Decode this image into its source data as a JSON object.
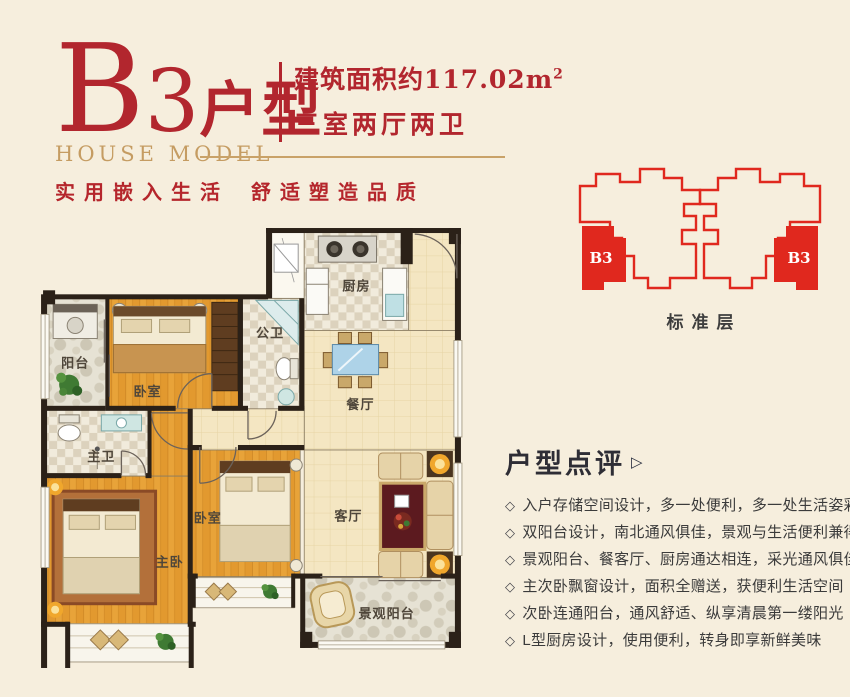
{
  "colors": {
    "background": "#f6eedd",
    "accent_red": "#b2262e",
    "keyplan_red": "#e0281e",
    "gold": "#c59c62",
    "text_dark": "#3b3b3b",
    "wall": "#2b2118",
    "wood_floor": "#e2992f",
    "tile_floor": "#f4e6c2"
  },
  "header": {
    "title_b": "B",
    "title_3": "3",
    "title_suffix": "户型",
    "subtitle_en": "HOUSE MODEL",
    "area_prefix": "建筑面积约",
    "area_value": "117.02",
    "area_unit": "m",
    "area_sup": "2",
    "layout_text": "三室两厅两卫",
    "tagline_left": "实用嵌入生活",
    "tagline_right": "舒适塑造品质"
  },
  "keyplan": {
    "unit_left": "B3",
    "unit_right": "B3",
    "caption": "标准层"
  },
  "floorplan": {
    "rooms": [
      {
        "label": "阳台"
      },
      {
        "label": "卧室"
      },
      {
        "label": "公卫"
      },
      {
        "label": "厨房"
      },
      {
        "label": "餐厅"
      },
      {
        "label": "主卫"
      },
      {
        "label": "主卧"
      },
      {
        "label": "卧室"
      },
      {
        "label": "客厅"
      },
      {
        "label": "景观阳台"
      }
    ]
  },
  "review": {
    "title": "户型点评",
    "marker": "▷",
    "bullet_icon": "◇",
    "bullets": [
      "入户存储空间设计，多一处便利，多一处生活姿彩",
      "双阳台设计，南北通风俱佳，景观与生活便利兼得",
      "景观阳台、餐客厅、厨房通达相连，采光通风俱佳",
      "主次卧飘窗设计，面积全赠送，获便利生活空间",
      "次卧连通阳台，通风舒适、纵享清晨第一缕阳光",
      "L型厨房设计，使用便利，转身即享新鲜美味"
    ]
  }
}
